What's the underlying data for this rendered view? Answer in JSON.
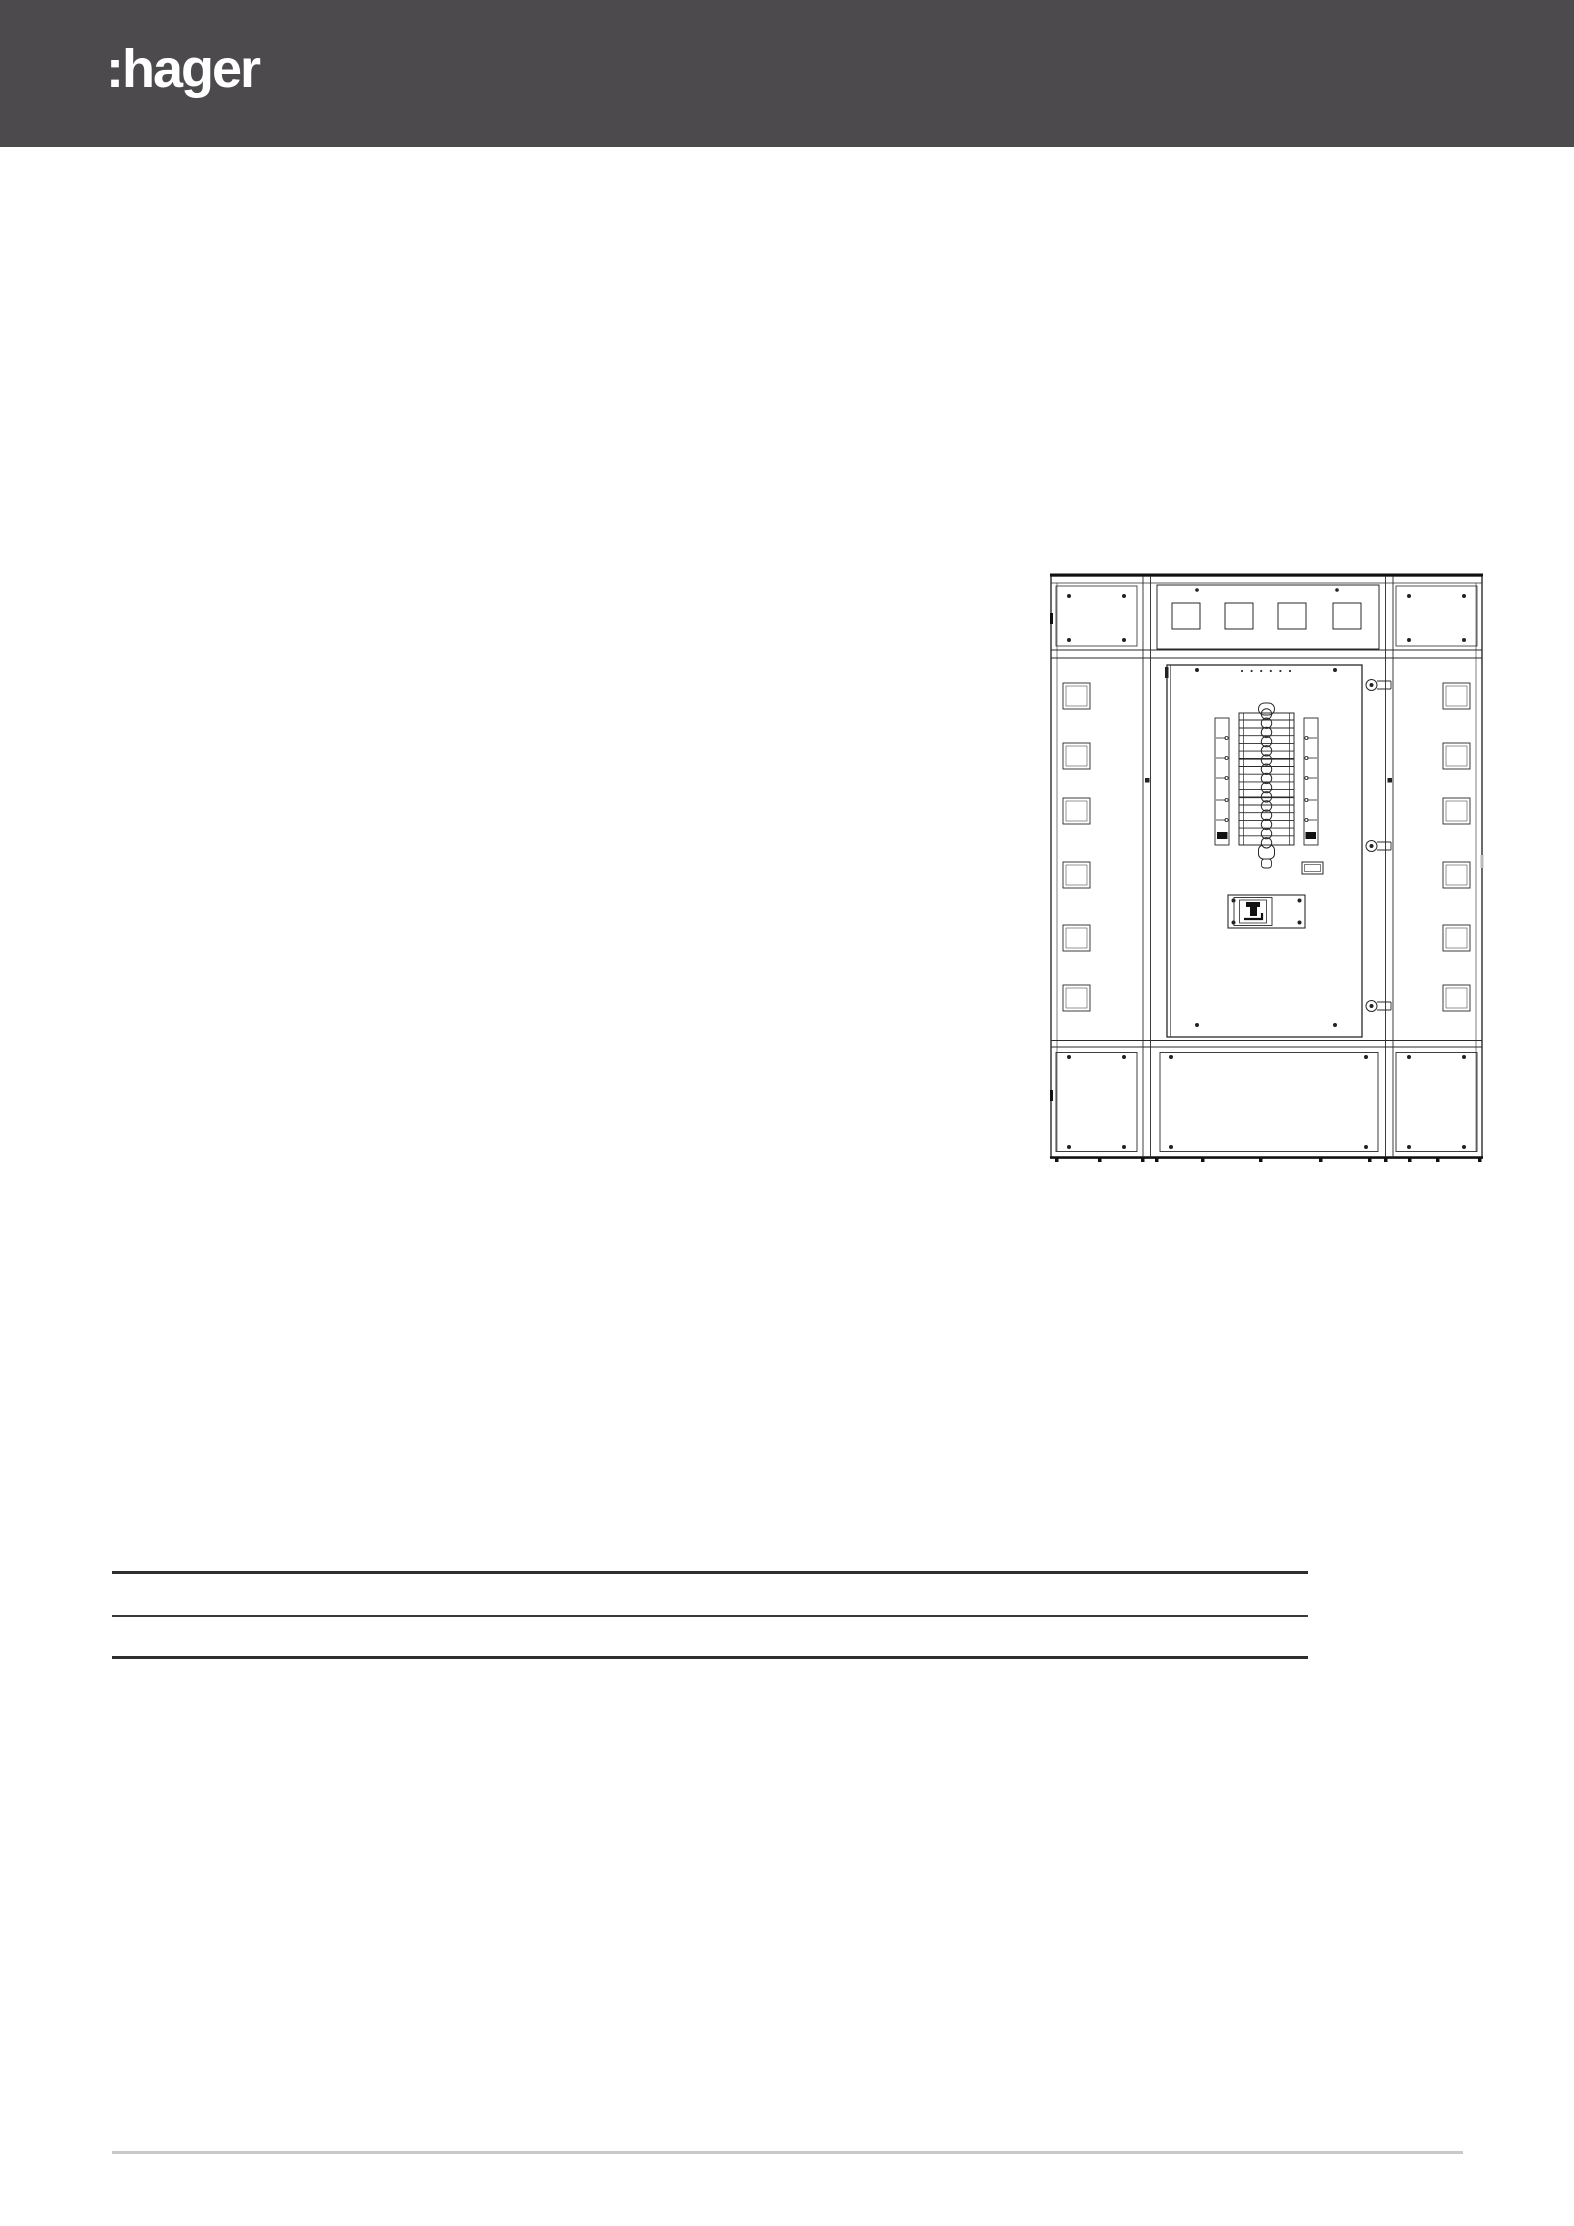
{
  "header": {
    "logo_text": ":hager",
    "background_color": "#4c4a4c",
    "logo_color": "#ffffff"
  },
  "illustration": {
    "icon": "switchboard-front-view-drawing",
    "line_color": "#2a2a2a"
  },
  "spec_table": {
    "rule_color": "#2e2e2e"
  },
  "footer": {
    "divider_color": "#c9c9c9"
  }
}
